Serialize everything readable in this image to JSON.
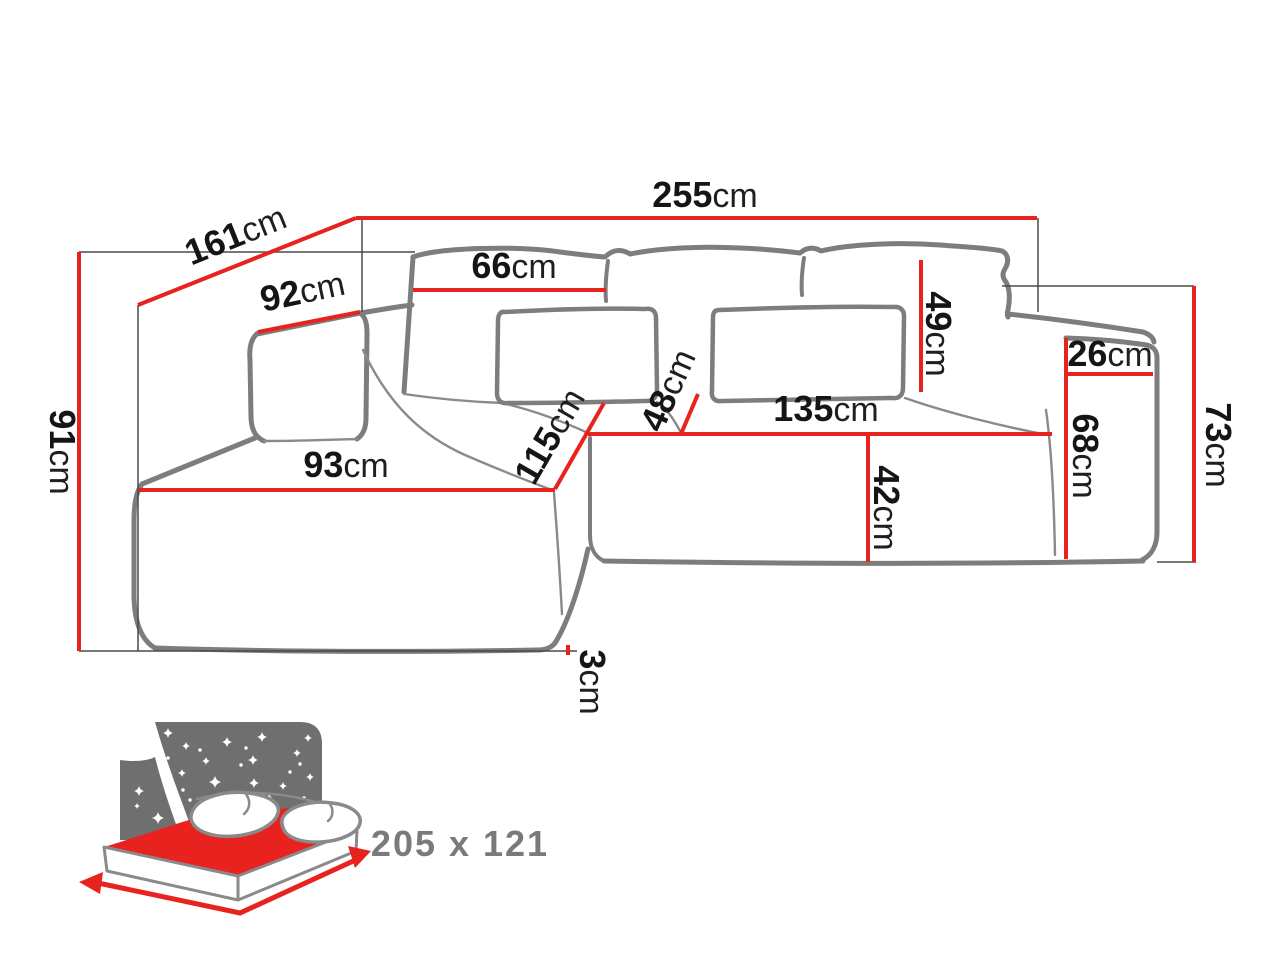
{
  "diagram": {
    "subject": "corner-sofa-dimension-drawing",
    "unit": "cm"
  },
  "dimensions": {
    "total_width": {
      "value": "255",
      "unit": "cm"
    },
    "depth_diagonal": {
      "value": "161",
      "unit": "cm"
    },
    "height_left": {
      "value": "91",
      "unit": "cm"
    },
    "corner_back_width": {
      "value": "92",
      "unit": "cm"
    },
    "back_cushion_width": {
      "value": "66",
      "unit": "cm"
    },
    "back_cushion_height": {
      "value": "49",
      "unit": "cm"
    },
    "armrest_top_width": {
      "value": "26",
      "unit": "cm"
    },
    "height_right": {
      "value": "73",
      "unit": "cm"
    },
    "armrest_height": {
      "value": "68",
      "unit": "cm"
    },
    "chaise_seat_length": {
      "value": "115",
      "unit": "cm"
    },
    "seat_depth": {
      "value": "48",
      "unit": "cm"
    },
    "seat_front_width": {
      "value": "135",
      "unit": "cm"
    },
    "seat_height": {
      "value": "42",
      "unit": "cm"
    },
    "chaise_front_width": {
      "value": "93",
      "unit": "cm"
    },
    "base_clearance": {
      "value": "3",
      "unit": "cm"
    }
  },
  "sleeping_function": {
    "size_label": "205 x 121"
  },
  "colors": {
    "dimension_red": "#e8231f",
    "sofa_outline_gray": "#7d7d7d",
    "construction_gray": "#4a4a4a",
    "icon_night_gray": "#6f6f6f",
    "label_text_black": "#151515",
    "bed_size_gray": "#7a7a7a"
  }
}
